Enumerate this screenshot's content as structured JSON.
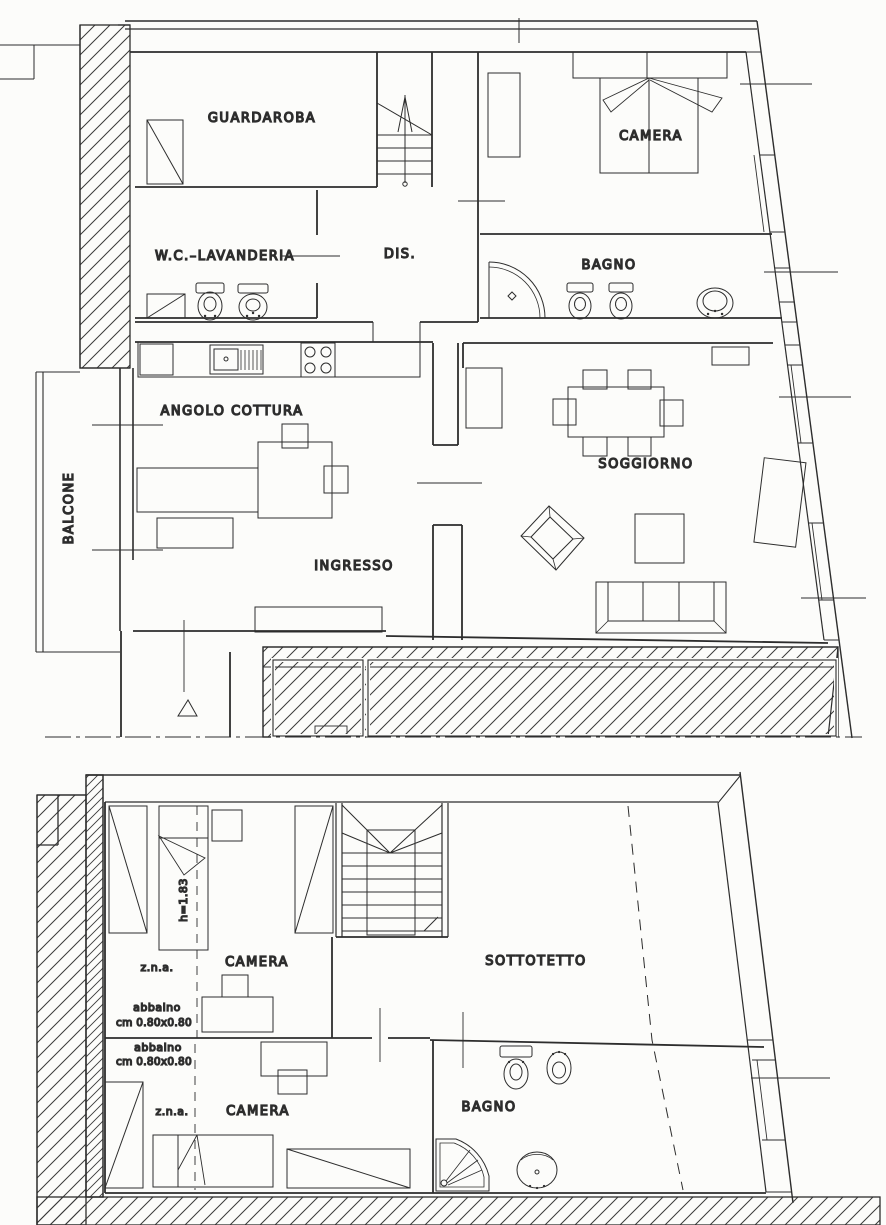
{
  "document": {
    "upper_floor": {
      "guardaroba": "GUARDAROBA",
      "camera": "CAMERA",
      "wc_lavanderia": "W.C.–LAVANDERIA",
      "disimpegno": "DIS.",
      "bagno": "BAGNO",
      "angolo_cottura": "ANGOLO COTTURA",
      "balcone": "BALCONE",
      "soggiorno": "SOGGIORNO",
      "ingresso": "INGRESSO"
    },
    "lower_floor": {
      "camera_1": "CAMERA",
      "camera_2": "CAMERA",
      "sottotetto": "SOTTOTETTO",
      "bagno": "BAGNO",
      "zna_1": "z.n.a.",
      "zna_2": "z.n.a.",
      "height_note": "h=1.83",
      "abbaino_1_word": "abbaino",
      "abbaino_1_size": "cm 0.80x0.80",
      "abbaino_2_word": "abbaino",
      "abbaino_2_size": "cm 0.80x0.80"
    },
    "colors": {
      "ink": "#2d2d2d",
      "paper": "#fcfcfa"
    }
  }
}
